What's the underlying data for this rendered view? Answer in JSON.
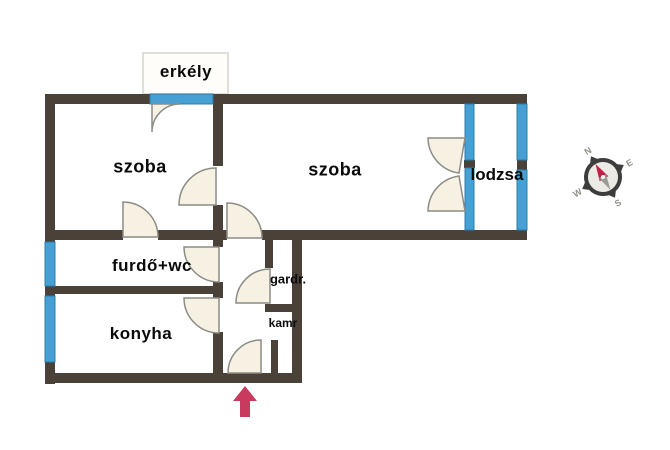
{
  "rooms": {
    "balcony": {
      "label": "erkély"
    },
    "room1": {
      "label": "szoba"
    },
    "room2": {
      "label": "szoba"
    },
    "loggia": {
      "label": "lodzsa"
    },
    "bathroom": {
      "label": "furdő+wc"
    },
    "kitchen": {
      "label": "konyha"
    },
    "wardrobe": {
      "label": "gardr."
    },
    "pantry": {
      "label": "kamr"
    }
  },
  "compass": {
    "north": "N",
    "east": "E",
    "south": "S",
    "west": "W"
  },
  "colors": {
    "wall": "#4a4139",
    "window_fill": "#46a0d4",
    "door_fill": "#f7f1e4",
    "entrance_arrow": "#c93a5f",
    "needle_north": "#c22045",
    "needle_south": "#9b9b94",
    "compass_ring": "#3d3d3b",
    "compass_face": "#eceae5"
  }
}
